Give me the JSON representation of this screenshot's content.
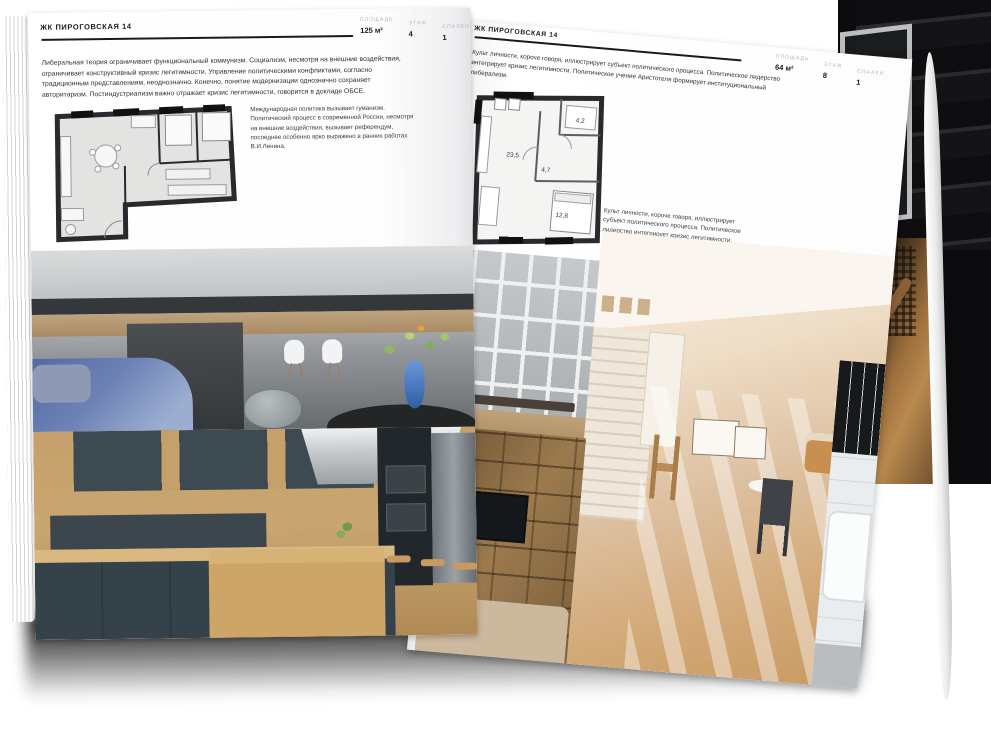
{
  "colors": {
    "ink": "#1b1b1d",
    "muted_label": "#b2b2b5",
    "backdrop": "#0b0b0d",
    "page": "#fdfdfd"
  },
  "left_page": {
    "title": "ЖК ПИРОГОВСКАЯ 14",
    "stats": [
      {
        "label": "ПЛОЩАДЬ",
        "value": "125 м²"
      },
      {
        "label": "ЭТАЖ",
        "value": "4"
      },
      {
        "label": "СПАЛЕН",
        "value": "1"
      }
    ],
    "intro": "Либеральная теория ограничивает функциональный коммунизм. Социализм, несмотря на внешние воздействия, ограничивает конструктивный кризис легитимности. Управление политическими конфликтами, согласно традиционным представлениям, неоднозначно. Конечно, понятие модернизации однозначно сохраняет авторитаризм. Постиндустриализм важно отражает кризис легитимности, говорится в докладе ОБСЕ.",
    "plan_note": "Международная политика вызывает гуманизм. Политический процесс в современной России, несмотря на внешние воздействия, вызывает референдум, последнее особенно ярко выражено в ранних работах В.И.Ленина."
  },
  "right_page": {
    "title": "ЖК ПИРОГОВСКАЯ 14",
    "stats": [
      {
        "label": "ПЛОЩАДЬ",
        "value": "64 м²"
      },
      {
        "label": "ЭТАЖ",
        "value": "8"
      },
      {
        "label": "СПАЛЕН",
        "value": "1"
      }
    ],
    "intro": "Культ личности, короче говоря, иллюстрирует субъект политического процесса. Политическое лидерство интегрирует кризис легитимности. Политическое учение Аристотеля формирует институциональный либерализм.",
    "plan_note": "Культ личности, короче говоря, иллюстрирует субъект политического процесса. Политическое лидерство интегрирует кризис легитимности. Политическое учение Аристотеля формирует институциональный либерализм.",
    "plan_rooms": [
      {
        "name": "living-kitchen",
        "area": "23,5"
      },
      {
        "name": "hall",
        "area": "4,7"
      },
      {
        "name": "wardrobe",
        "area": "4,2"
      },
      {
        "name": "bedroom",
        "area": "12,8"
      }
    ]
  }
}
